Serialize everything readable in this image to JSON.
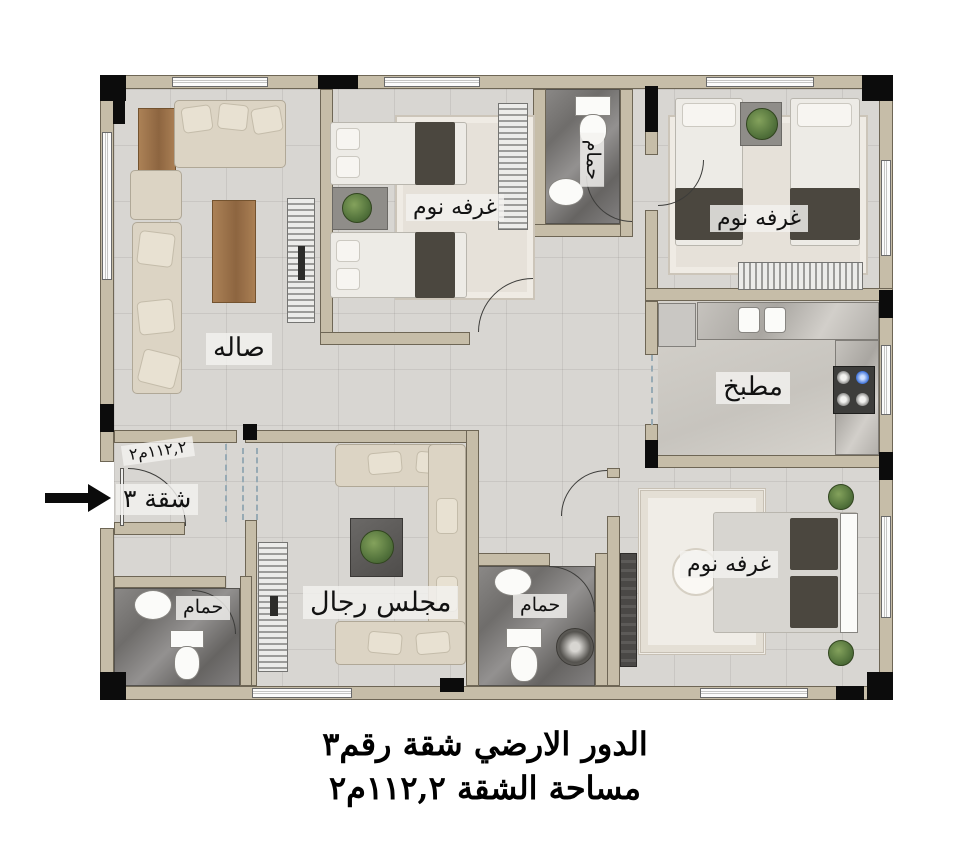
{
  "caption": {
    "line1": "الدور الارضي شقة رقم٣",
    "line2": "مساحة الشقة ١١٢,٢م٢"
  },
  "labels": {
    "living_room": "صاله",
    "bedroom": "غرفه نوم",
    "bathroom": "حمام",
    "kitchen": "مطبخ",
    "majlis": "مجلس رجال",
    "apartment": "شقة ٣",
    "area": "١١٢,٢م٢"
  },
  "colors": {
    "wall": "#c6bda8",
    "wall_outline": "#6e6655",
    "column": "#0c0c0c",
    "floor": "#d8d6d2",
    "bathroom_floor": "#6f6d6b",
    "label_background": "#f3f2ef",
    "blanket": "#4b473f",
    "plant": "#50703a",
    "arrow": "#0b0b0b"
  }
}
